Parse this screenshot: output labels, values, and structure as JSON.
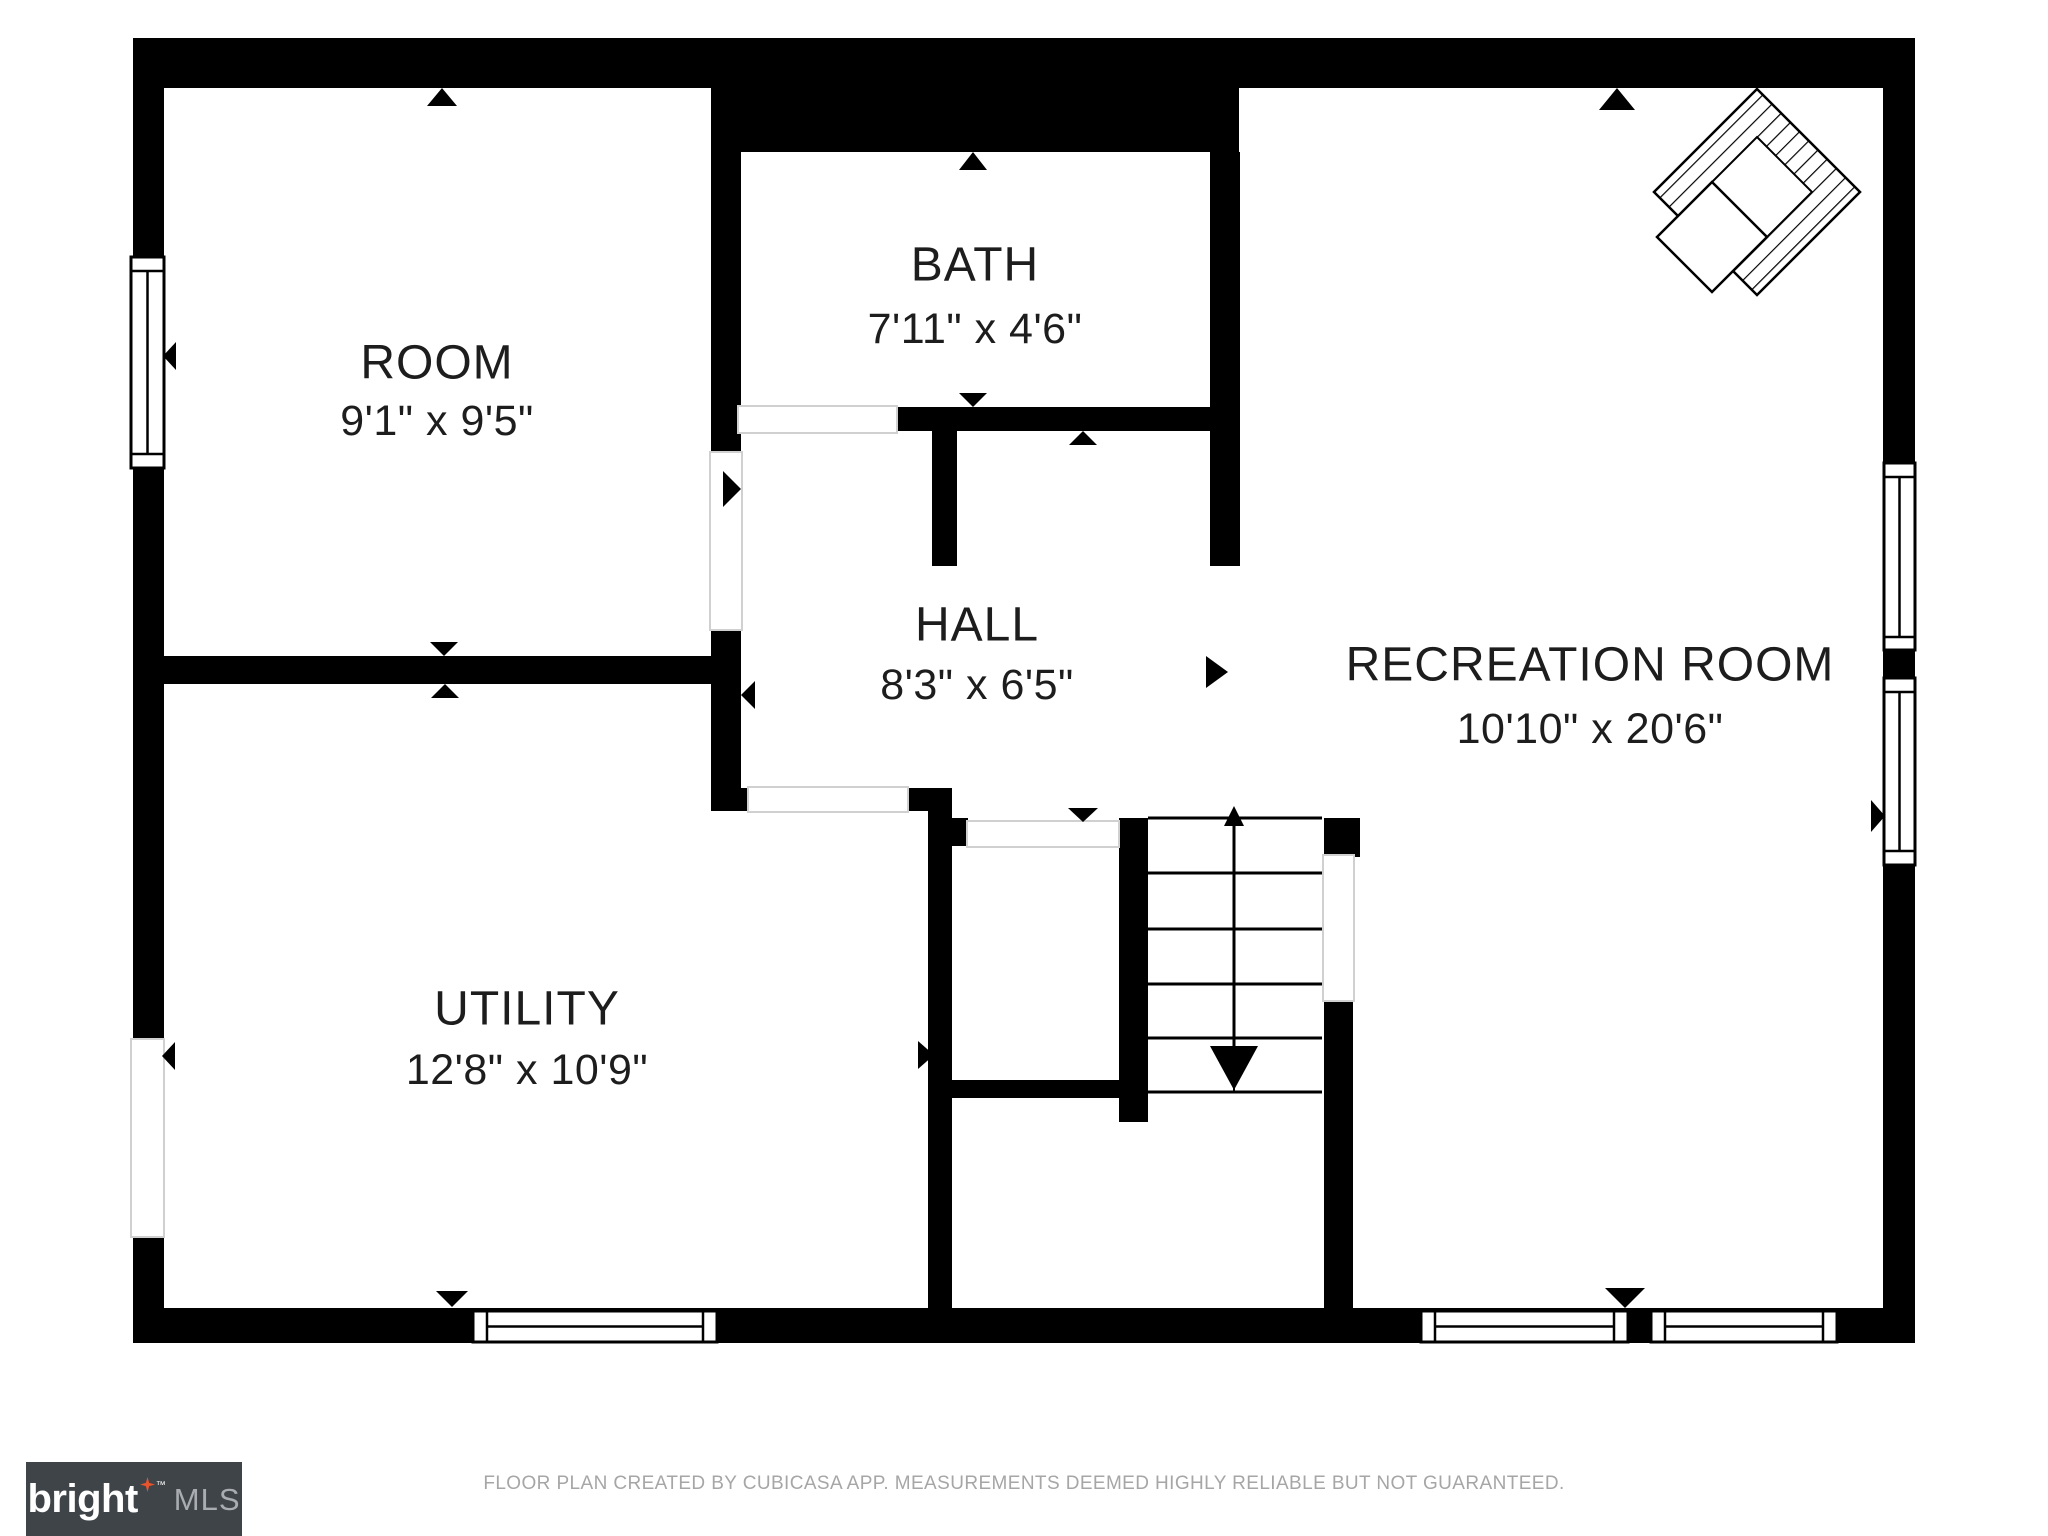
{
  "rooms": {
    "room": {
      "name": "ROOM",
      "dims": "9'1\" x 9'5\""
    },
    "bath": {
      "name": "BATH",
      "dims": "7'11\" x 4'6\""
    },
    "hall": {
      "name": "HALL",
      "dims": "8'3\" x 6'5\""
    },
    "recreation": {
      "name": "RECREATION ROOM",
      "dims": "10'10\" x 20'6\""
    },
    "utility": {
      "name": "UTILITY",
      "dims": "12'8\" x 10'9\""
    }
  },
  "footer": {
    "disclaimer": "FLOOR PLAN CREATED BY CUBICASA APP. MEASUREMENTS DEEMED HIGHLY RELIABLE BUT NOT GUARANTEED."
  },
  "logo": {
    "brand": "bright",
    "trademark": "™",
    "mls": "MLS"
  },
  "colors": {
    "wall": "#000000",
    "label": "#1d1d1d",
    "door_line": "#d0d0d0",
    "footer_text": "#a6a6a6",
    "logo_bg": "#3f4449",
    "logo_brand": "#ffffff",
    "logo_mls": "#a9adb1",
    "logo_star": "#e8542e"
  },
  "icons": {
    "fireplace": "hatched-diamond",
    "staircase": "treads-with-down-arrow",
    "door_markers": "direction-triangles",
    "logo_star": "four-point-star"
  }
}
